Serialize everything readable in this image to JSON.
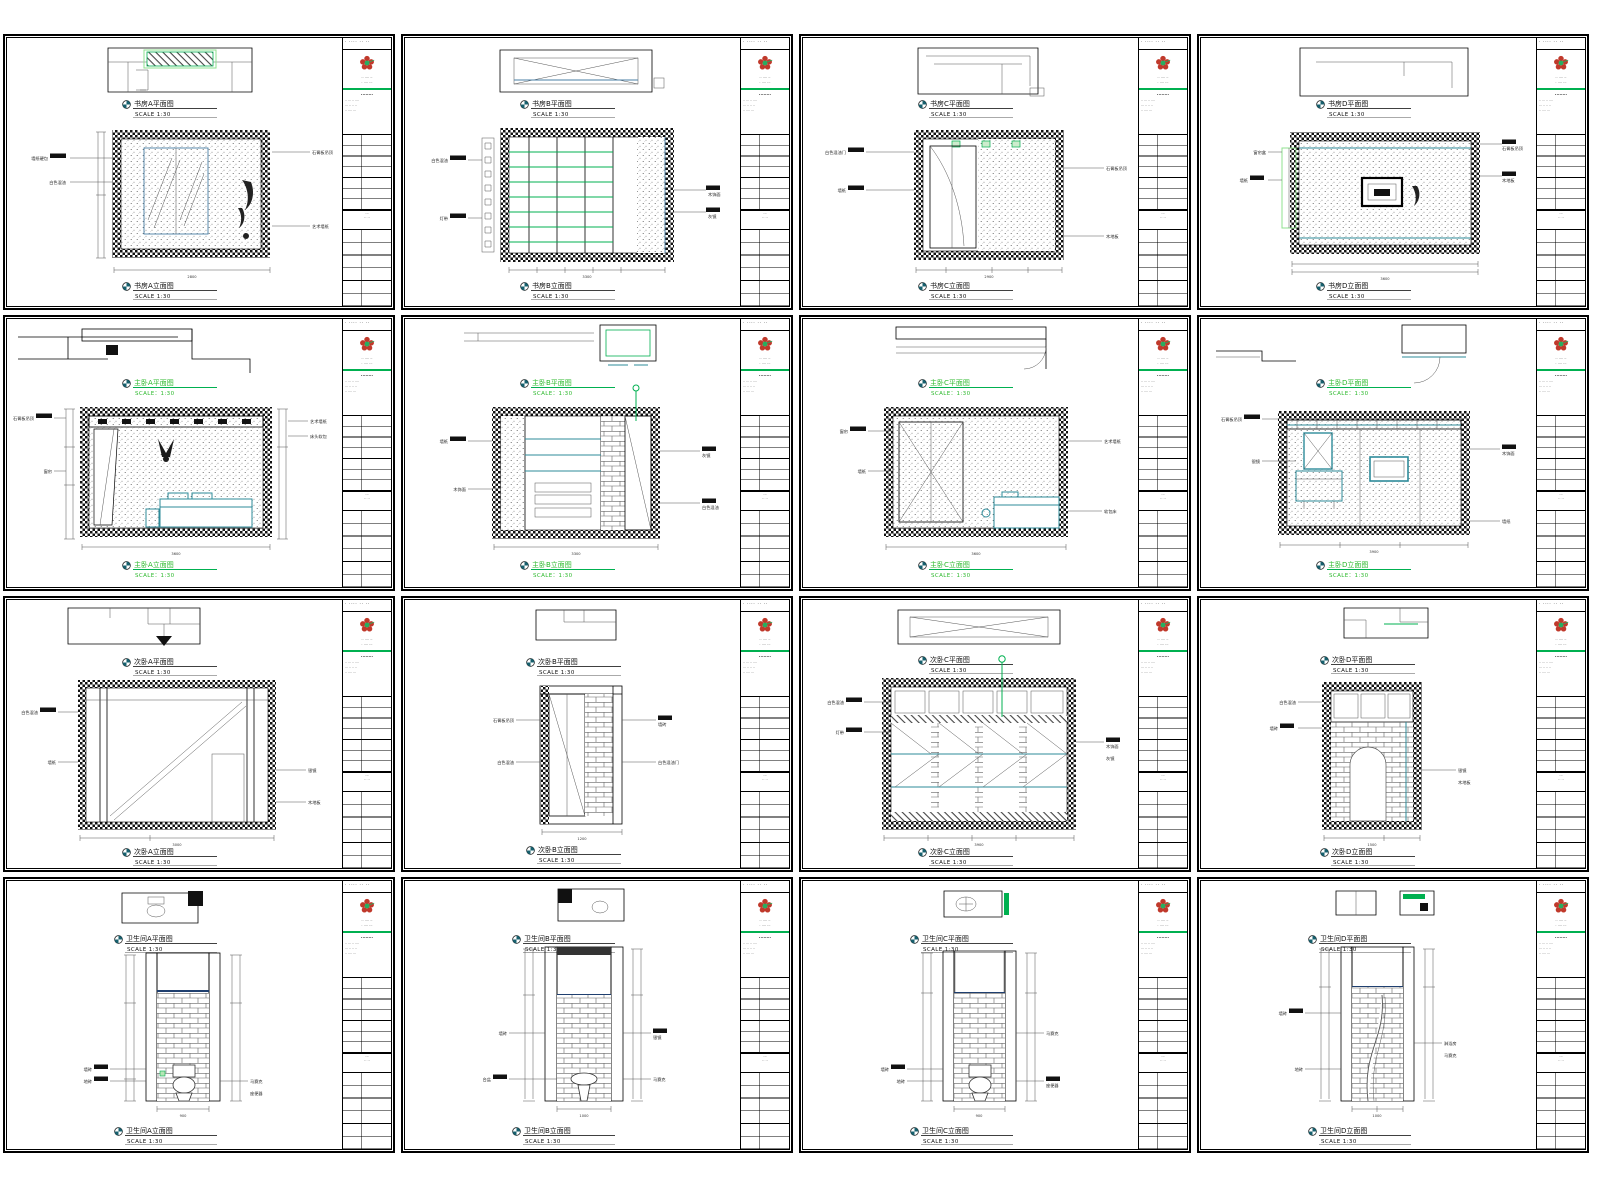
{
  "page": {
    "title": "Interior design CAD elevation sheet set",
    "background": "#ffffff",
    "grid": {
      "rows": 4,
      "cols": 4
    }
  },
  "palette": {
    "line": "#000000",
    "accent_green": "#00b050",
    "label_green": "#2db92d",
    "teal": "#2e8b9a",
    "steel_blue": "#4a7fa5",
    "logo_red": "#c0392b",
    "logo_green": "#27ae60"
  },
  "titleblock": {
    "header": "· ···· ··  ··",
    "company": "·· ···· ··\n· ···· ···",
    "section": "········",
    "notes": "·· ··· ·· ····\n··· ·· ·· ··\n·· ···· ···",
    "mid": "···\n·· ··",
    "logo": "flower-logo"
  },
  "sheets": [
    {
      "id": "r1c1",
      "room": "书房",
      "letter": "A",
      "top_label": "书房A平面图",
      "bottom_label": "书房A立面图",
      "scale": "SCALE 1:30",
      "dim": "2800",
      "lann": [
        "墙纸硬包",
        "白色混油"
      ],
      "rann": [
        "石膏板吊顶",
        "艺术墙纸"
      ]
    },
    {
      "id": "r1c2",
      "room": "书房",
      "letter": "B",
      "top_label": "书房B平面图",
      "bottom_label": "书房B立面图",
      "scale": "SCALE 1:30",
      "dim": "3300",
      "lann": [
        "白色混油",
        "灯带"
      ],
      "rann": [
        "木饰面",
        "灰镜"
      ]
    },
    {
      "id": "r1c3",
      "room": "书房",
      "letter": "C",
      "top_label": "书房C平面图",
      "bottom_label": "书房C立面图",
      "scale": "SCALE 1:30",
      "dim": "2900",
      "lann": [
        "白色混油门",
        "墙纸"
      ],
      "rann": [
        "石膏板吊顶",
        "木地板"
      ]
    },
    {
      "id": "r1c4",
      "room": "书房",
      "letter": "D",
      "top_label": "书房D平面图",
      "bottom_label": "书房D立面图",
      "scale": "SCALE 1:30",
      "dim": "3600",
      "lann": [
        "窗帘盒",
        "墙纸"
      ],
      "rann": [
        "石膏板吊顶",
        "木地板"
      ]
    },
    {
      "id": "r2c1",
      "room": "主卧",
      "letter": "A",
      "top_label": "主卧A平面图",
      "bottom_label": "主卧A立面图",
      "scale": "SCALE：1:30",
      "dim": "3600",
      "lann": [
        "石膏板吊顶",
        "窗帘"
      ],
      "rann": [
        "艺术墙纸",
        "床头软包"
      ]
    },
    {
      "id": "r2c2",
      "room": "主卧",
      "letter": "B",
      "top_label": "主卧B平面图",
      "bottom_label": "主卧B立面图",
      "scale": "SCALE：1:30",
      "dim": "3300",
      "lann": [
        "墙纸",
        "木饰面"
      ],
      "rann": [
        "灰镜",
        "白色混油"
      ]
    },
    {
      "id": "r2c3",
      "room": "主卧",
      "letter": "C",
      "top_label": "主卧C平面图",
      "bottom_label": "主卧C立面图",
      "scale": "SCALE：1:30",
      "dim": "3600",
      "lann": [
        "窗帘",
        "墙纸"
      ],
      "rann": [
        "艺术墙纸",
        "软包床"
      ]
    },
    {
      "id": "r2c4",
      "room": "主卧",
      "letter": "D",
      "top_label": "主卧D平面图",
      "bottom_label": "主卧D立面图",
      "scale": "SCALE：1:30",
      "dim": "3900",
      "lann": [
        "石膏板吊顶",
        "银镜"
      ],
      "rann": [
        "木饰面",
        "墙纸"
      ]
    },
    {
      "id": "r3c1",
      "room": "次卧",
      "letter": "A",
      "top_label": "次卧A平面图",
      "bottom_label": "次卧A立面图",
      "scale": "SCALE 1:30",
      "dim": "3000",
      "lann": [
        "白色混油",
        "墙纸"
      ],
      "rann": [
        "银镜",
        "木地板"
      ]
    },
    {
      "id": "r3c2",
      "room": "次卧",
      "letter": "B",
      "top_label": "次卧B平面图",
      "bottom_label": "次卧B立面图",
      "scale": "SCALE 1:30",
      "dim": "1200",
      "lann": [
        "石膏板吊顶",
        "白色混油"
      ],
      "rann": [
        "墙砖",
        "白色混油门"
      ]
    },
    {
      "id": "r3c3",
      "room": "次卧",
      "letter": "C",
      "top_label": "次卧C平面图",
      "bottom_label": "次卧C立面图",
      "scale": "SCALE 1:30",
      "dim": "3900",
      "lann": [
        "白色混油",
        "灯带"
      ],
      "rann": [
        "木饰面",
        "灰镜"
      ]
    },
    {
      "id": "r3c4",
      "room": "次卧",
      "letter": "D",
      "top_label": "次卧D平面图",
      "bottom_label": "次卧D立面图",
      "scale": "SCALE 1:30",
      "dim": "1500",
      "lann": [
        "白色混油",
        "墙砖"
      ],
      "rann": [
        "银镜",
        "木地板"
      ]
    },
    {
      "id": "r4c1",
      "room": "卫生间",
      "letter": "A",
      "top_label": "卫生间A平面图",
      "bottom_label": "卫生间A立面图",
      "scale": "SCALE 1:30",
      "dim": "900",
      "lann": [
        "墙砖",
        "地砖"
      ],
      "rann": [
        "马赛克",
        "座便器"
      ]
    },
    {
      "id": "r4c2",
      "room": "卫生间",
      "letter": "B",
      "top_label": "卫生间B平面图",
      "bottom_label": "卫生间B立面图",
      "scale": "SCALE 1:30",
      "dim": "1000",
      "lann": [
        "墙砖",
        "台盆"
      ],
      "rann": [
        "银镜",
        "马赛克"
      ]
    },
    {
      "id": "r4c3",
      "room": "卫生间",
      "letter": "C",
      "top_label": "卫生间C平面图",
      "bottom_label": "卫生间C立面图",
      "scale": "SCALE 1:30",
      "dim": "900",
      "lann": [
        "墙砖",
        "地砖"
      ],
      "rann": [
        "马赛克",
        "座便器"
      ]
    },
    {
      "id": "r4c4",
      "room": "卫生间",
      "letter": "D",
      "top_label": "卫生间D平面图",
      "bottom_label": "卫生间D立面图",
      "scale": "SCALE 1:30",
      "dim": "1000",
      "lann": [
        "墙砖",
        "地砖"
      ],
      "rann": [
        "淋浴房",
        "马赛克"
      ]
    }
  ]
}
